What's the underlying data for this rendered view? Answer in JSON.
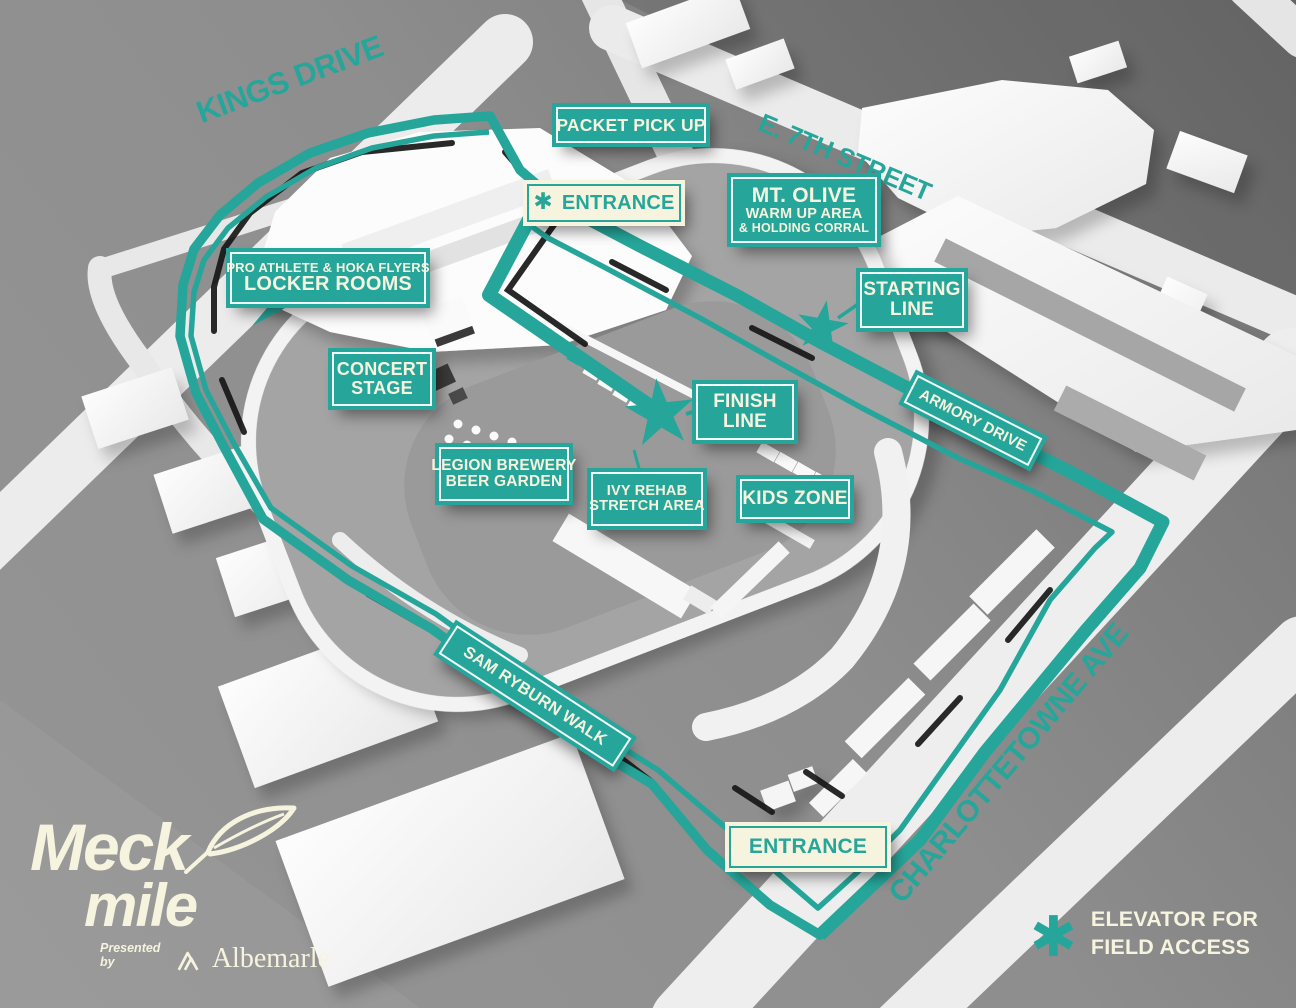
{
  "map": {
    "streets": {
      "kings_drive": "KINGS DRIVE",
      "e_7th_street": "E. 7TH STREET",
      "armory_drive": "ARMORY DRIVE",
      "charlottetowne_ave": "CHARLOTTETOWNE AVE",
      "sam_ryburn_walk": "SAM RYBURN WALK"
    },
    "signs": {
      "packet_pickup": "PACKET PICK UP",
      "entrance_top": "ENTRANCE",
      "entrance_bottom": "ENTRANCE",
      "mt_olive": {
        "line1": "MT. OLIVE",
        "line2": "WARM UP AREA",
        "line3": "& HOLDING CORRAL"
      },
      "starting_line": {
        "line1": "STARTING",
        "line2": "LINE"
      },
      "finish_line": {
        "line1": "FINISH",
        "line2": "LINE"
      },
      "locker_rooms": {
        "line1": "PRO ATHLETE & HOKA FLYERS",
        "line2": "LOCKER ROOMS"
      },
      "concert_stage": {
        "line1": "CONCERT",
        "line2": "STAGE"
      },
      "legion_brewery": {
        "line1": "LEGION BREWERY",
        "line2": "BEER GARDEN"
      },
      "ivy_rehab": {
        "line1": "IVY REHAB",
        "line2": "STRETCH AREA"
      },
      "kids_zone": "KIDS ZONE"
    },
    "icons": {
      "star_glyph": "✱"
    },
    "legend": {
      "line1": "ELEVATOR FOR",
      "line2": "FIELD ACCESS"
    },
    "logo": {
      "word1": "Meck",
      "word2": "mile",
      "presented_by": "Presented by",
      "sponsor": "Albemarle"
    },
    "colors": {
      "teal": "#26a69a",
      "cream": "#f6f3de"
    }
  }
}
